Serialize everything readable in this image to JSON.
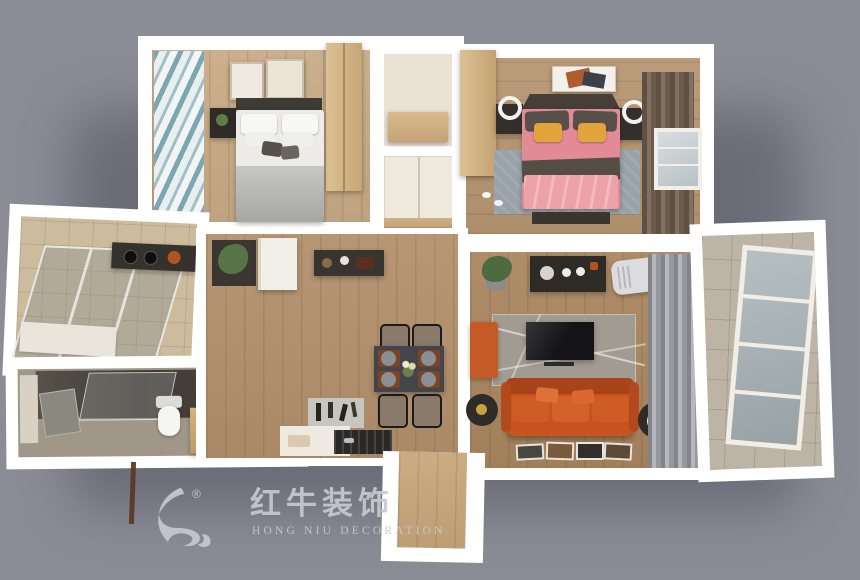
{
  "watermark": {
    "brand_cn": "红牛装饰",
    "brand_en": "HONG NIU DECORATION",
    "registered": "®",
    "color": "#c8c8d1"
  },
  "scene": {
    "type": "3d-top-down-apartment-render",
    "background": "#8b8c96",
    "wall": "#ffffff",
    "rooms": [
      "secondary-bedroom",
      "hallway-closets",
      "master-bedroom",
      "kitchen",
      "bathroom",
      "dining-hall",
      "living-room",
      "balcony",
      "entry"
    ],
    "colors": {
      "wood_floor": "#b2906c",
      "wood_floor_light": "#c9ab87",
      "kitchen_tile": "#cdbb9e",
      "balcony_tile": "#bdb4a6",
      "bathroom_floor": "#a09788",
      "sofa_orange": "#c8531f",
      "accent_bench_orange": "#c65a26",
      "bed_pink": "#e28b96",
      "duvet_pink": "#eda2aa",
      "pillow_yellow": "#e2a33b",
      "gray_blanket": "#b4b4b2",
      "curtain_teal": "#7ba7b2",
      "curtain_brown": "#6b5b4d",
      "curtain_gray": "#9a9aa1",
      "dark_furniture": "#34302b",
      "rug_living": "#a19b91",
      "rug_master": "#99a2a9",
      "cabinet_wood": "#d5b688"
    }
  }
}
